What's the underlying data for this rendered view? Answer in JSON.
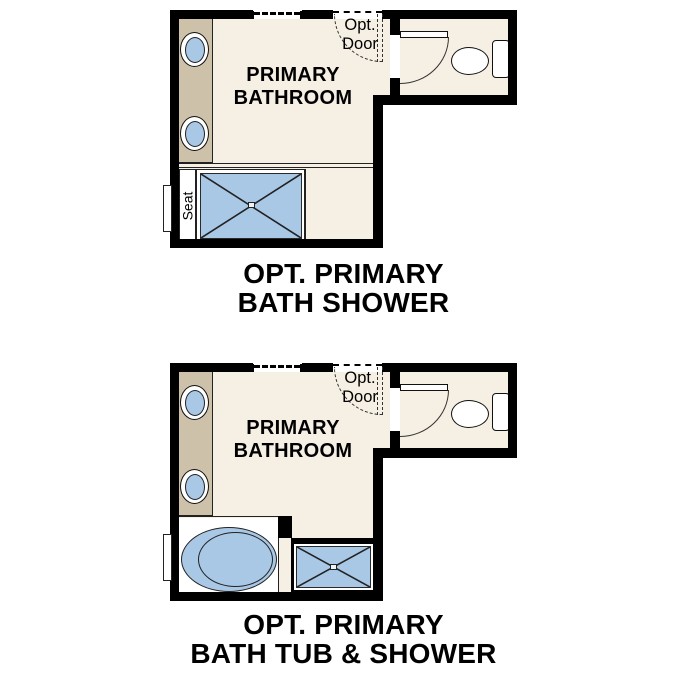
{
  "theme": {
    "bg": "#ffffff",
    "wall": "#000000",
    "line": "#222222",
    "floor": "#f6efe3",
    "counter": "#cdc1a9",
    "blue": "#a9c8e6",
    "text": "#000000"
  },
  "plans": [
    {
      "room_line1": "PRIMARY",
      "room_line2": "BATHROOM",
      "opt_door_line1": "Opt.",
      "opt_door_line2": "Door",
      "seat": "Seat",
      "title_line1": "OPT. PRIMARY",
      "title_line2": "BATH SHOWER"
    },
    {
      "room_line1": "PRIMARY",
      "room_line2": "BATHROOM",
      "opt_door_line1": "Opt.",
      "opt_door_line2": "Door",
      "title_line1": "OPT. PRIMARY",
      "title_line2": "BATH TUB & SHOWER"
    }
  ]
}
